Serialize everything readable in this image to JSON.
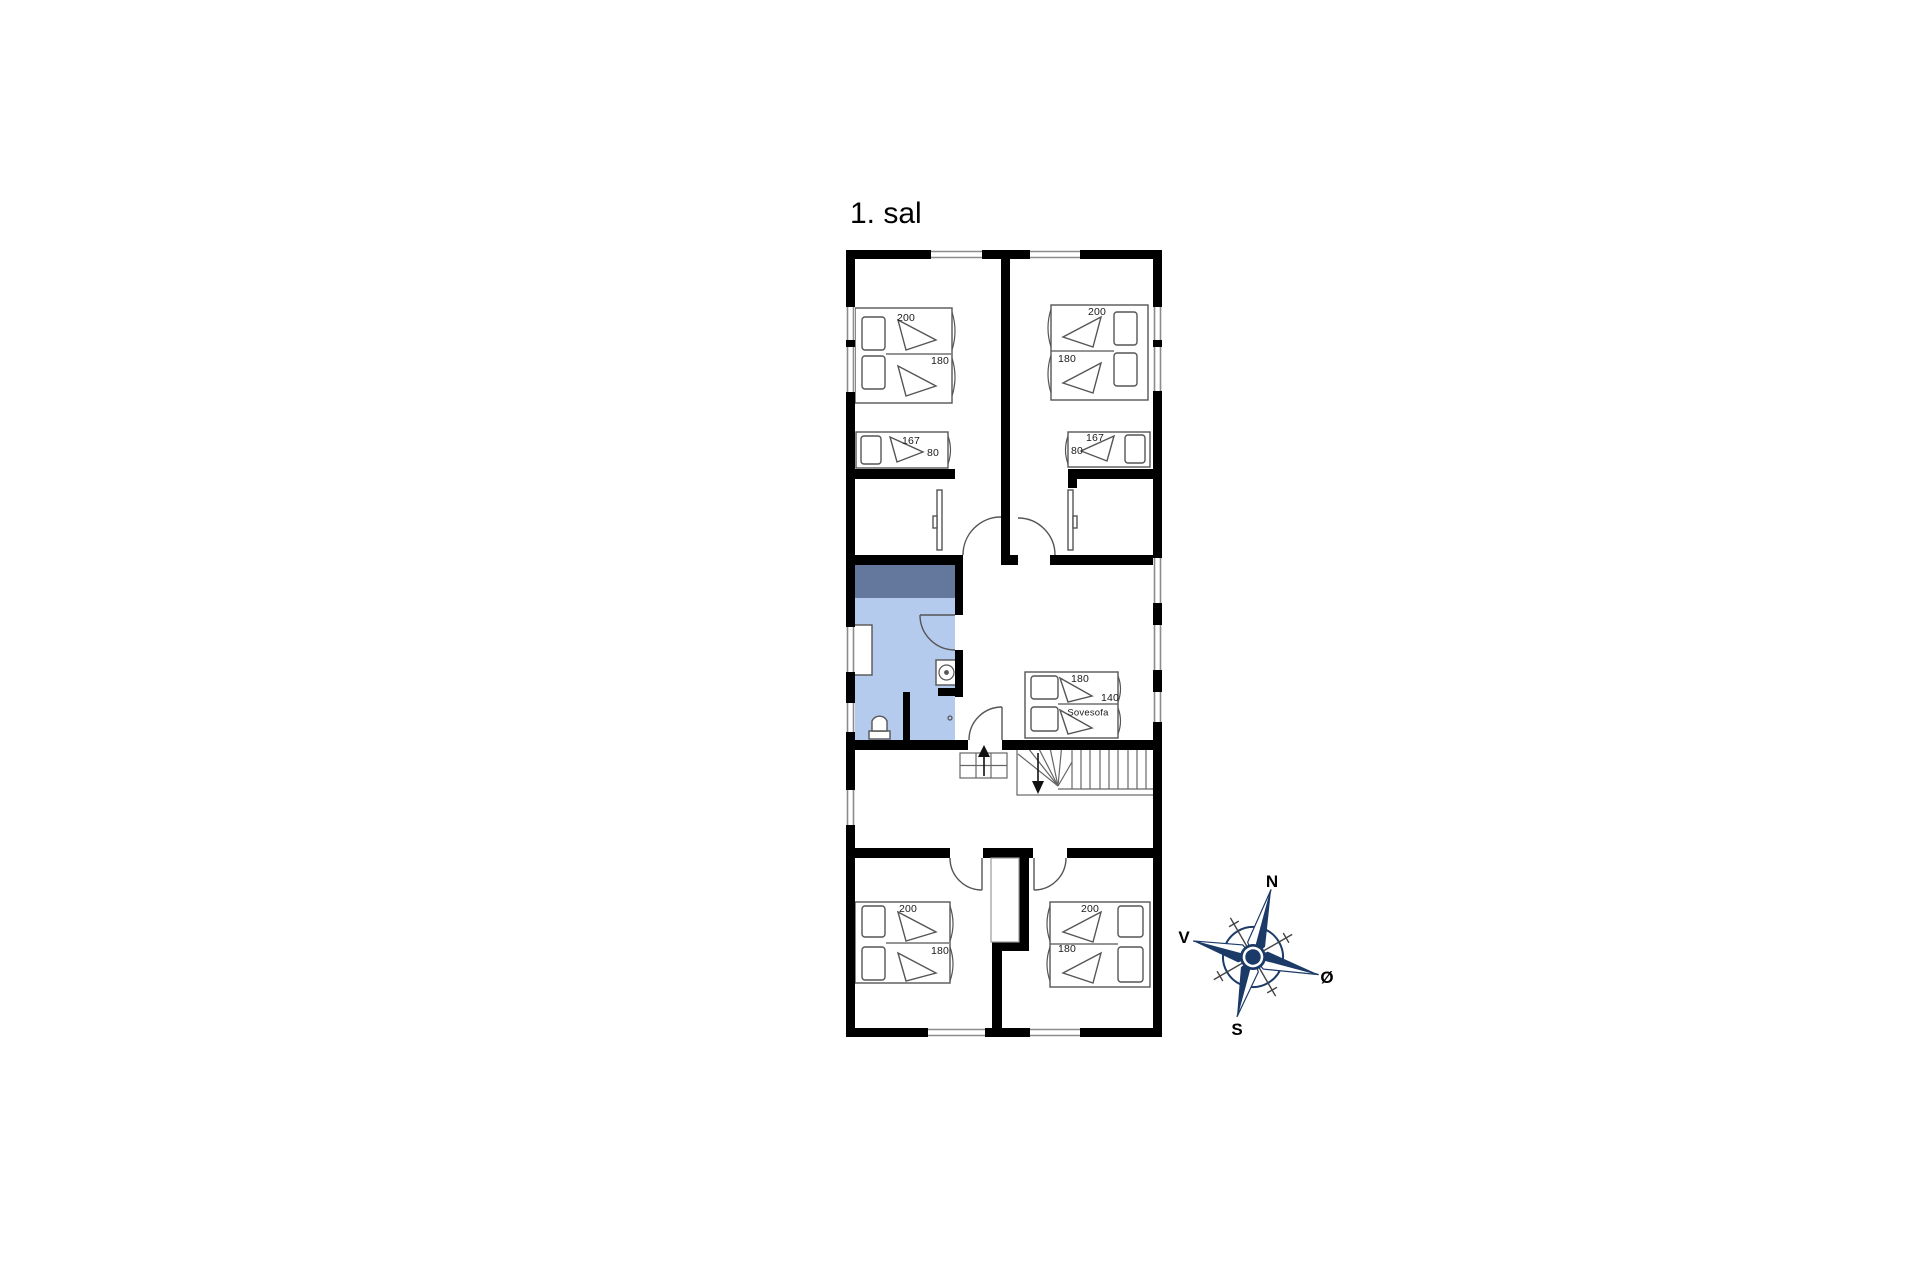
{
  "title": "1. sal",
  "compass": {
    "n": "N",
    "s": "S",
    "v": "V",
    "o": "Ø"
  },
  "rooms": {
    "top_left": {
      "bed200": "200",
      "bed180": "180",
      "bed167": "167",
      "bed80": "80"
    },
    "top_right": {
      "bed200": "200",
      "bed180": "180",
      "bed167": "167",
      "bed80": "80"
    },
    "middle": {
      "sofa180": "180",
      "sofa140": "140",
      "sofa_name": "Sovesofa"
    },
    "bottom_left": {
      "bed200": "200",
      "bed180": "180"
    },
    "bottom_right": {
      "bed200": "200",
      "bed180": "180"
    }
  },
  "colors": {
    "bath_fill": "#b5cbee",
    "bath_band": "#64789e",
    "compass_navy": "#1c3a67",
    "wall": "#000000"
  }
}
